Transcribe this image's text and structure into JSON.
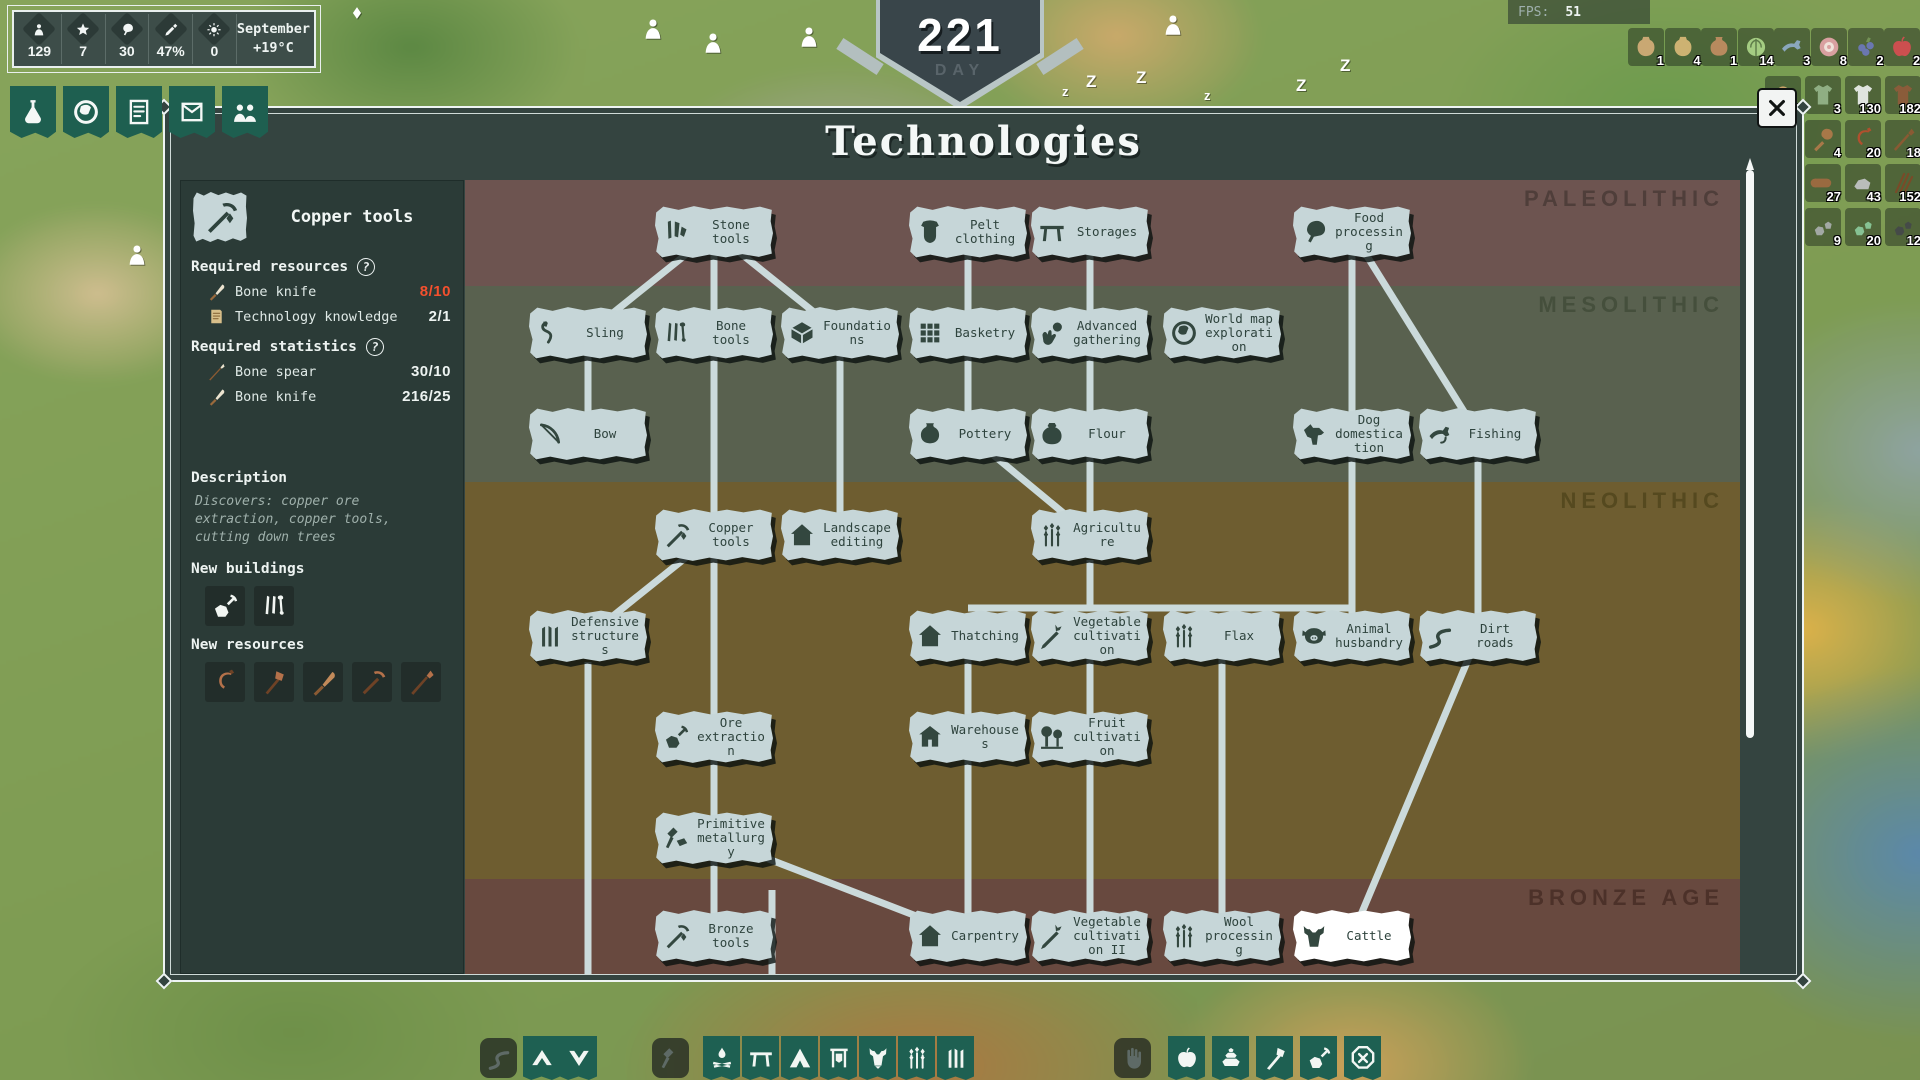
{
  "hud": {
    "month": "September",
    "temperature": "+19°C",
    "stats": [
      {
        "icon": "person",
        "value": "129"
      },
      {
        "icon": "star",
        "value": "7"
      },
      {
        "icon": "meat",
        "value": "30"
      },
      {
        "icon": "sword",
        "value": "47%"
      },
      {
        "icon": "sun",
        "value": "0"
      }
    ]
  },
  "day_banner": {
    "value": "221",
    "label": "DAY"
  },
  "fps": {
    "label": "FPS:",
    "value": "51"
  },
  "tabs": [
    {
      "name": "technologies",
      "icon": "flask"
    },
    {
      "name": "world",
      "icon": "globe"
    },
    {
      "name": "chronicle",
      "icon": "scroll"
    },
    {
      "name": "reports",
      "icon": "letter"
    },
    {
      "name": "population",
      "icon": "people"
    }
  ],
  "top_resources": [
    {
      "icon": "bag-seeds",
      "value": "1",
      "color": "#c9a873"
    },
    {
      "icon": "bag-straw",
      "value": "4",
      "color": "#cdb272"
    },
    {
      "icon": "jug",
      "value": "1",
      "color": "#b88a5e"
    },
    {
      "icon": "cabbage",
      "value": "14",
      "color": "#a4cc82"
    },
    {
      "icon": "fish",
      "value": "3",
      "color": "#8aa7bd"
    },
    {
      "icon": "meat-cut",
      "value": "8",
      "color": "#d9a0a0"
    },
    {
      "icon": "berries",
      "value": "2",
      "color": "#6a77b0"
    },
    {
      "icon": "apple",
      "value": "2",
      "color": "#cc4f4f"
    }
  ],
  "side_resources": [
    [
      {
        "icon": "basket",
        "value": "4",
        "color": "#c9a469"
      },
      {
        "icon": "tunic",
        "value": "3",
        "color": "#8fae83"
      },
      {
        "icon": "shirt",
        "value": "130",
        "color": "#dfe4de"
      },
      {
        "icon": "coat",
        "value": "182",
        "color": "#8a5c3a"
      }
    ],
    [
      {
        "icon": "pickaxe-tool",
        "value": "4",
        "color": "#b4714a"
      },
      {
        "icon": "club",
        "value": "4",
        "color": "#a87848"
      },
      {
        "icon": "sickle",
        "value": "20",
        "color": "#b0502e"
      },
      {
        "icon": "hoe",
        "value": "18",
        "color": "#8a5a33"
      }
    ],
    [
      {
        "icon": "bone",
        "value": "29",
        "color": "#e8e0ca"
      },
      {
        "icon": "log",
        "value": "27",
        "color": "#9a6a40"
      },
      {
        "icon": "stone",
        "value": "43",
        "color": "#b9bdbb"
      },
      {
        "icon": "fibers",
        "value": "152",
        "color": "#7a4a28"
      }
    ],
    [
      {
        "icon": "ingot",
        "value": "4",
        "color": "#c4795b"
      },
      {
        "icon": "rocks",
        "value": "9",
        "color": "#a2a8a4"
      },
      {
        "icon": "ore-green",
        "value": "20",
        "color": "#86c293"
      },
      {
        "icon": "coal",
        "value": "12",
        "color": "#454a48"
      }
    ]
  ],
  "map_markers": [
    {
      "icon": "villager",
      "x": 640,
      "y": 16
    },
    {
      "icon": "villager",
      "x": 700,
      "y": 30
    },
    {
      "icon": "villager",
      "x": 796,
      "y": 24
    },
    {
      "icon": "villager",
      "x": 934,
      "y": 22
    },
    {
      "icon": "villager",
      "x": 1160,
      "y": 12
    },
    {
      "icon": "villager",
      "x": 124,
      "y": 242
    },
    {
      "icon": "diamond",
      "x": 350,
      "y": 6
    },
    {
      "icon": "sleep-z",
      "x": 1062,
      "y": 84,
      "t": "z"
    },
    {
      "icon": "sleep-z",
      "x": 1086,
      "y": 72,
      "t": "Z"
    },
    {
      "icon": "sleep-z",
      "x": 1136,
      "y": 68,
      "t": "Z"
    },
    {
      "icon": "sleep-z",
      "x": 1204,
      "y": 88,
      "t": "z"
    },
    {
      "icon": "sleep-z",
      "x": 1296,
      "y": 76,
      "t": "Z"
    },
    {
      "icon": "sleep-z",
      "x": 1340,
      "y": 56,
      "t": "Z"
    },
    {
      "icon": "sleep-z",
      "x": 1566,
      "y": 110,
      "t": "Z"
    }
  ],
  "dialog": {
    "title": "Technologies",
    "sidebar": {
      "icon": "pickaxe",
      "title": "Copper tools",
      "required_resources": {
        "label": "Required resources",
        "items": [
          {
            "icon": "bone-knife",
            "label": "Bone knife",
            "value": "8/10",
            "insufficient": true
          },
          {
            "icon": "tech-scroll",
            "label": "Technology knowledge",
            "value": "2/1",
            "insufficient": false
          }
        ]
      },
      "required_statistics": {
        "label": "Required statistics",
        "items": [
          {
            "icon": "bone-spear",
            "label": "Bone spear",
            "value": "30/10"
          },
          {
            "icon": "bone-knife",
            "label": "Bone knife",
            "value": "216/25"
          }
        ]
      },
      "description": {
        "label": "Description",
        "text": "Discovers: copper ore extraction, copper tools, cutting down trees"
      },
      "new_buildings": {
        "label": "New buildings",
        "icons": [
          "quarry",
          "bone-pile"
        ]
      },
      "new_resources": {
        "label": "New resources",
        "icons": [
          "copper-sickle",
          "copper-axe",
          "copper-knife",
          "copper-pickaxe",
          "copper-hoe"
        ]
      }
    },
    "eras": [
      {
        "label": "PALEOLITHIC",
        "band": "#6d5450",
        "text": "#4f3e3a",
        "top": 0,
        "height": 106
      },
      {
        "label": "MESOLITHIC",
        "band": "#59614f",
        "text": "#454f3c",
        "top": 106,
        "height": 196
      },
      {
        "label": "NEOLITHIC",
        "band": "#6e5d30",
        "text": "#55491f",
        "top": 302,
        "height": 397
      },
      {
        "label": "BRONZE AGE",
        "band": "#68493f",
        "text": "#4c3129",
        "top": 699,
        "height": 95
      }
    ],
    "nodes": [
      {
        "id": "stone-tools",
        "label": "Stone tools",
        "icon": "stone-tools",
        "x": 712,
        "y": 230
      },
      {
        "id": "pelt-clothing",
        "label": "Pelt clothing",
        "icon": "pelt",
        "x": 966,
        "y": 230
      },
      {
        "id": "storages",
        "label": "Storages",
        "icon": "table",
        "x": 1088,
        "y": 230
      },
      {
        "id": "food-processing",
        "label": "Food processing",
        "icon": "food",
        "x": 1350,
        "y": 230
      },
      {
        "id": "sling",
        "label": "Sling",
        "icon": "sling",
        "x": 586,
        "y": 331
      },
      {
        "id": "bone-tools",
        "label": "Bone tools",
        "icon": "bones",
        "x": 712,
        "y": 331
      },
      {
        "id": "foundations",
        "label": "Foundations",
        "icon": "foundation",
        "x": 838,
        "y": 331
      },
      {
        "id": "basketry",
        "label": "Basketry",
        "icon": "basketry",
        "x": 966,
        "y": 331
      },
      {
        "id": "advanced-gathering",
        "label": "Advanced gathering",
        "icon": "hand-fruit",
        "x": 1088,
        "y": 331
      },
      {
        "id": "world-map-exploration",
        "label": "World map exploration",
        "icon": "world",
        "x": 1220,
        "y": 331
      },
      {
        "id": "bow",
        "label": "Bow",
        "icon": "bow",
        "x": 586,
        "y": 432
      },
      {
        "id": "pottery",
        "label": "Pottery",
        "icon": "pottery",
        "x": 966,
        "y": 432
      },
      {
        "id": "flour",
        "label": "Flour",
        "icon": "sack",
        "x": 1088,
        "y": 432
      },
      {
        "id": "dog-domestication",
        "label": "Dog domestication",
        "icon": "dog",
        "x": 1350,
        "y": 432
      },
      {
        "id": "fishing",
        "label": "Fishing",
        "icon": "fish-hook",
        "x": 1476,
        "y": 432
      },
      {
        "id": "copper-tools",
        "label": "Copper tools",
        "icon": "pickaxe",
        "x": 712,
        "y": 533
      },
      {
        "id": "landscape-editing",
        "label": "Landscape editing",
        "icon": "house",
        "x": 838,
        "y": 533
      },
      {
        "id": "agriculture",
        "label": "Agriculture",
        "icon": "wheat",
        "x": 1088,
        "y": 533
      },
      {
        "id": "defensive-structures",
        "label": "Defensive structures",
        "icon": "stakes",
        "x": 586,
        "y": 634
      },
      {
        "id": "thatching",
        "label": "Thatching",
        "icon": "house",
        "x": 966,
        "y": 634
      },
      {
        "id": "vegetable-cultivation",
        "label": "Vegetable cultivation",
        "icon": "carrot",
        "x": 1088,
        "y": 634
      },
      {
        "id": "flax",
        "label": "Flax",
        "icon": "wheat",
        "x": 1220,
        "y": 634
      },
      {
        "id": "animal-husbandry",
        "label": "Animal husbandry",
        "icon": "pig",
        "x": 1350,
        "y": 634
      },
      {
        "id": "dirt-roads",
        "label": "Dirt roads",
        "icon": "road",
        "x": 1476,
        "y": 634
      },
      {
        "id": "ore-extraction",
        "label": "Ore extraction",
        "icon": "mine",
        "x": 712,
        "y": 735
      },
      {
        "id": "warehouses",
        "label": "Warehouses",
        "icon": "barn",
        "x": 966,
        "y": 735
      },
      {
        "id": "fruit-cultivation",
        "label": "Fruit cultivation",
        "icon": "trees",
        "x": 1088,
        "y": 735
      },
      {
        "id": "primitive-metallurgy",
        "label": "Primitive metallurgy",
        "icon": "hammer-ingot",
        "x": 712,
        "y": 836
      },
      {
        "id": "bronze-tools",
        "label": "Bronze tools",
        "icon": "pickaxe",
        "x": 712,
        "y": 934
      },
      {
        "id": "carpentry",
        "label": "Carpentry",
        "icon": "house",
        "x": 966,
        "y": 934
      },
      {
        "id": "vegetable-cultivation-ii",
        "label": "Vegetable cultivation II",
        "icon": "carrot",
        "x": 1088,
        "y": 934
      },
      {
        "id": "wool-processing",
        "label": "Wool processing",
        "icon": "wheat",
        "x": 1220,
        "y": 934
      },
      {
        "id": "cattle",
        "label": "Cattle",
        "icon": "cattle",
        "x": 1350,
        "y": 934,
        "white": true
      }
    ],
    "edges": [
      [
        "stone-tools",
        "sling"
      ],
      [
        "stone-tools",
        "bone-tools"
      ],
      [
        "stone-tools",
        "foundations"
      ],
      [
        "pelt-clothing",
        "basketry"
      ],
      [
        "storages",
        "advanced-gathering"
      ],
      [
        "food-processing",
        "dog-domestication"
      ],
      [
        "food-processing",
        "fishing"
      ],
      [
        "sling",
        "bow"
      ],
      [
        "bone-tools",
        "copper-tools"
      ],
      [
        "foundations",
        "landscape-editing"
      ],
      [
        "basketry",
        "pottery"
      ],
      [
        "advanced-gathering",
        "flour"
      ],
      [
        "pottery",
        "agriculture"
      ],
      [
        "flour",
        "agriculture"
      ],
      [
        "dog-domestication",
        "animal-husbandry"
      ],
      [
        "fishing",
        "dirt-roads"
      ],
      [
        "copper-tools",
        "defensive-structures"
      ],
      [
        "copper-tools",
        "ore-extraction"
      ],
      [
        "thatching",
        "warehouses"
      ],
      [
        "vegetable-cultivation",
        "fruit-cultivation"
      ],
      [
        "flax",
        "wool-processing"
      ],
      [
        "ore-extraction",
        "primitive-metallurgy"
      ],
      [
        "warehouses",
        "carpentry"
      ],
      [
        "fruit-cultivation",
        "vegetable-cultivation-ii"
      ],
      [
        "primitive-metallurgy",
        "bronze-tools"
      ],
      [
        "primitive-metallurgy",
        "carpentry"
      ],
      [
        "dirt-roads",
        "cattle"
      ]
    ],
    "extra_edges": [
      [
        1088,
        558,
        1088,
        606
      ],
      [
        966,
        606,
        1350,
        606
      ],
      [
        586,
        660,
        586,
        972
      ],
      [
        770,
        888,
        770,
        972
      ]
    ]
  },
  "toolbar": {
    "left": [
      {
        "icon": "road",
        "disabled": true
      },
      {
        "icon": "chevron-up"
      },
      {
        "icon": "chevron-down"
      },
      {
        "icon": "hammer",
        "disabled": true
      },
      {
        "icon": "campfire"
      },
      {
        "icon": "table"
      },
      {
        "icon": "tent"
      },
      {
        "icon": "drying-rack"
      },
      {
        "icon": "goat"
      },
      {
        "icon": "wheat"
      },
      {
        "icon": "stakes"
      }
    ],
    "right": [
      {
        "icon": "hand",
        "disabled": true
      },
      {
        "icon": "apple"
      },
      {
        "icon": "stones"
      },
      {
        "icon": "axe"
      },
      {
        "icon": "mine"
      },
      {
        "icon": "cancel"
      }
    ]
  }
}
